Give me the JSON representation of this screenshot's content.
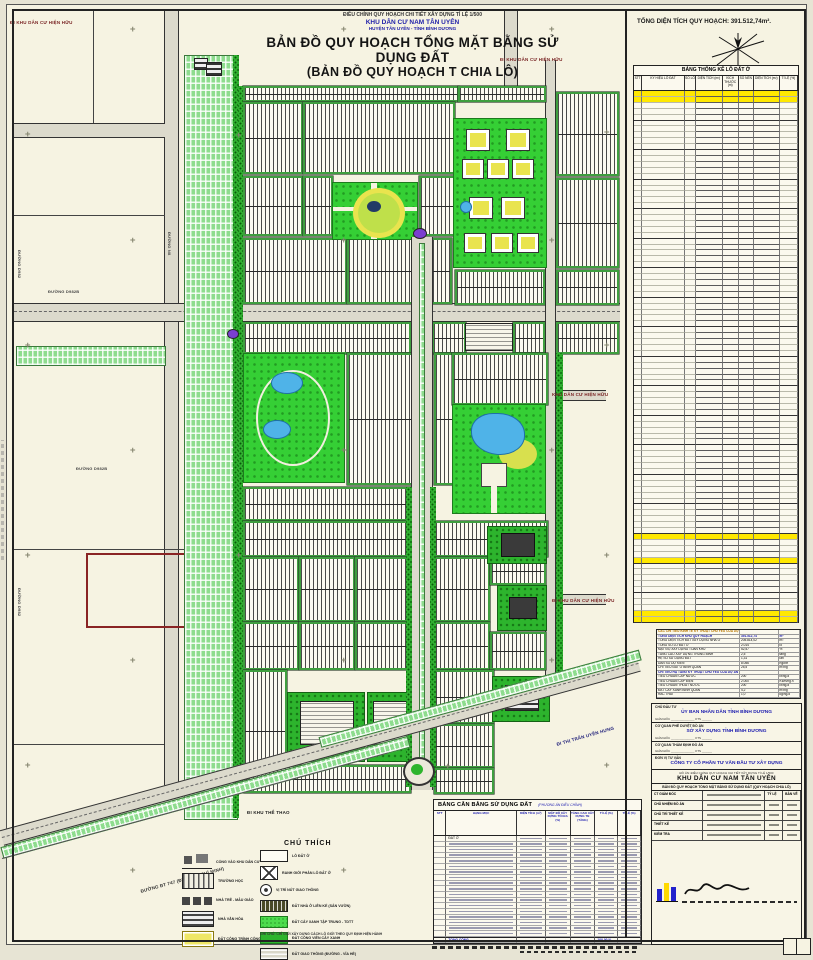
{
  "header": {
    "line1": "ĐIỀU CHỈNH QUY HOẠCH CHI TIẾT XÂY DỰNG TỈ LỆ 1/500",
    "line2": "KHU DÂN CƯ NAM TÂN UYÊN",
    "line3": "HUYỆN TÂN UYÊN - TỈNH BÌNH DƯƠNG",
    "title1": "BẢN ĐỒ QUY HOẠCH TỔNG MẶT BẰNG SỬ DỤNG ĐẤT",
    "title2": "(BẢN ĐỒ QUY HOẠCH T CHIA LÔ)",
    "total_area": "TỔNG DIỆN TÍCH QUY HOẠCH: 391.512,74m²."
  },
  "map": {
    "labels": [
      {
        "text": "ĐI KHU DÂN CƯ HIỆN HỮU",
        "x": 10,
        "y": 20,
        "rot": 0,
        "color": "#7a2525",
        "size": 4.5
      },
      {
        "text": "ĐI KHU DÂN CƯ HIỆN HỮU",
        "x": 500,
        "y": 57,
        "rot": 0,
        "color": "#7a2525",
        "size": 4.5
      },
      {
        "text": "KHU DÂN CƯ HIỆN HỮU",
        "x": 552,
        "y": 392,
        "rot": 0,
        "color": "#7a2525",
        "size": 4.5
      },
      {
        "text": "ĐI KHU DÂN CƯ HIỆN HỮU",
        "x": 552,
        "y": 598,
        "rot": 0,
        "color": "#7a2525",
        "size": 4.5
      },
      {
        "text": "ĐI THỊ TRẤN UYÊN HƯNG",
        "x": 556,
        "y": 742,
        "rot": -16,
        "color": "#20207a",
        "size": 4.5
      },
      {
        "text": "ĐƯỜNG ĐT 747 (ĐI TP. HỒ CHÍ MINH)",
        "x": 140,
        "y": 889,
        "rot": -15.5,
        "color": "#333333",
        "size": 4.5
      },
      {
        "text": "ĐƯỜNG D982B",
        "x": 48,
        "y": 289,
        "rot": 0,
        "color": "#444444",
        "size": 4
      },
      {
        "text": "ĐƯỜNG D982B",
        "x": 76,
        "y": 466,
        "rot": 0,
        "color": "#444444",
        "size": 4
      },
      {
        "text": "ĐƯỜNG D982",
        "x": 22,
        "y": 250,
        "rot": 90,
        "color": "#444444",
        "size": 4
      },
      {
        "text": "ĐƯỜNG D982",
        "x": 22,
        "y": 588,
        "rot": 90,
        "color": "#444444",
        "size": 4
      },
      {
        "text": "ĐƯỜNG N8",
        "x": 172,
        "y": 232,
        "rot": 90,
        "color": "#444444",
        "size": 4
      },
      {
        "text": "ĐI KHU THỂ THAO",
        "x": 247,
        "y": 810,
        "rot": 0,
        "color": "#222222",
        "size": 4.5
      }
    ],
    "crosses": [
      [
        130,
        25
      ],
      [
        341,
        25
      ],
      [
        549,
        25
      ],
      [
        25,
        130
      ],
      [
        236,
        131
      ],
      [
        604,
        128
      ],
      [
        130,
        236
      ],
      [
        341,
        236
      ],
      [
        549,
        236
      ],
      [
        25,
        341
      ],
      [
        604,
        341
      ],
      [
        130,
        446
      ],
      [
        341,
        446
      ],
      [
        549,
        446
      ],
      [
        25,
        551
      ],
      [
        236,
        551
      ],
      [
        604,
        551
      ],
      [
        130,
        656
      ],
      [
        341,
        656
      ],
      [
        549,
        656
      ],
      [
        25,
        761
      ],
      [
        445,
        762
      ],
      [
        604,
        761
      ],
      [
        130,
        866
      ],
      [
        341,
        866
      ],
      [
        467,
        866
      ]
    ]
  },
  "stat_table": {
    "title": "BẢNG THỐNG KÊ LÔ ĐẤT Ở",
    "columns": [
      "STT",
      "KÝ HIỆU LÔ ĐẤT",
      "SỐ LÔ",
      "DIỆN TÍCH (m²)",
      "KÍCH THƯỚC (m)",
      "SỐ NỀN",
      "DIỆN TÍCH (m²)",
      "TỈ LỆ (%)"
    ],
    "row_count": 90,
    "yellow_rows": [
      0,
      1,
      75,
      79,
      88,
      89
    ]
  },
  "summary_table": {
    "rows": [
      {
        "l": "CÁC CHỈ TIÊU KINH TẾ KỸ THUẬT CHỦ YẾU CỦA DỰ ÁN",
        "v": "",
        "u": "",
        "s": "head"
      },
      {
        "l": "TỔNG DIỆN TÍCH KHU QUY HOẠCH",
        "v": "391.512,74",
        "u": "m²",
        "s": "blue"
      },
      {
        "l": "TỔNG DIỆN TÍCH ĐẤT XÂY DỰNG NHÀ Ở",
        "v": "205.814,02",
        "u": "m²",
        "s": "plain"
      },
      {
        "l": "TỔNG SỐ LÔ ĐẤT Ở",
        "v": "2.014",
        "u": "lô",
        "s": "plain"
      },
      {
        "l": "MẬT ĐỘ XÂY DỰNG TOÀN KHU",
        "v": "52,57",
        "u": "%",
        "s": "plain"
      },
      {
        "l": "TẦNG CAO XÂY DỰNG TRUNG BÌNH",
        "v": "2,5",
        "u": "tầng",
        "s": "plain"
      },
      {
        "l": "HỆ SỐ SỬ DỤNG ĐẤT",
        "v": "1,31",
        "u": "lần",
        "s": "plain"
      },
      {
        "l": "DÂN SỐ DỰ KIẾN",
        "v": "8.056",
        "u": "người",
        "s": "plain"
      },
      {
        "l": "CHỈ TIÊU ĐẤT Ở BÌNH QUÂN",
        "v": "25,5",
        "u": "m²/ng",
        "s": "plain"
      },
      {
        "l": "CHỈ TIÊU HẠ TẦNG KỸ THUẬT CHỦ YẾU CỦA DỰ ÁN",
        "v": "",
        "u": "",
        "s": "blue"
      },
      {
        "l": "TIÊU CHUẨN CẤP NƯỚC",
        "v": "200",
        "u": "lít/ng.đ",
        "s": "plain"
      },
      {
        "l": "TIÊU CHUẨN CẤP ĐIỆN",
        "v": "2.000",
        "u": "KWh/ng.n",
        "s": "plain"
      },
      {
        "l": "TIÊU CHUẨN THOÁT NƯỚC",
        "v": "200",
        "u": "lít/ng.đ",
        "s": "plain"
      },
      {
        "l": "ĐẤT CÂY XANH BÌNH QUÂN",
        "v": "4,2",
        "u": "m²/ng",
        "s": "plain"
      },
      {
        "l": "RÁC THẢI",
        "v": "1,0",
        "u": "kg/ng.đ",
        "s": "plain"
      }
    ]
  },
  "balance_table": {
    "title": "BẢNG CÂN BẰNG SỬ DỤNG ĐẤT",
    "note": "(PHƯƠNG ÁN ĐIỀU CHỈNH)",
    "columns": [
      "STT",
      "HẠNG MỤC",
      "DIỆN TÍCH (m²)",
      "MẬT ĐỘ XÂY DỰNG TỐI ĐA (%)",
      "TẦNG CAO XÂY DỰNG TB (TẦNG)",
      "TỈ LỆ (%)",
      "TỈ LỆ (%)"
    ],
    "row_count": 19,
    "first_label": "ĐẤT Ở",
    "total_label": "TỔNG CỘNG",
    "total_value": "100,00 %"
  },
  "legend": {
    "title": "CHÚ THÍCH",
    "left_items": [
      {
        "icon": "gate-icon",
        "label": "CỔNG VÀO KHU DÂN CƯ"
      },
      {
        "icon": "school-icon",
        "label": "TRƯỜNG HỌC"
      },
      {
        "icon": "kindergarten-icon",
        "label": "NHÀ TRẺ - MẪU GIÁO"
      },
      {
        "icon": "market-icon",
        "label": "NHÀ VĂN HÓA"
      },
      {
        "icon": "public-icon",
        "label": "ĐẤT CÔNG TRÌNH CÔNG CỘNG"
      }
    ],
    "right_items": [
      {
        "icon": "lot-swatch",
        "label": "LÔ ĐẤT Ở"
      },
      {
        "icon": "boundary-swatch",
        "label": "RANH GIỚI PHÂN LÔ ĐẤT Ở"
      },
      {
        "icon": "node-swatch",
        "label": "VỊ TRÍ NÚT GIAO THÔNG"
      },
      {
        "icon": "rowhouse-swatch",
        "label": "ĐẤT NHÀ Ở LIÊN KẾ (SÂN VƯỜN)"
      },
      {
        "icon": "greenery-swatch",
        "label": "ĐẤT CÂY XANH TẬP TRUNG - TDTT"
      },
      {
        "icon": "park-swatch",
        "label": "ĐẤT CÔNG VIÊN CÂY XANH"
      },
      {
        "icon": "road-swatch",
        "label": "ĐẤT GIAO THÔNG (ĐƯỜNG - VỈA HÈ)"
      }
    ],
    "note": "GHI CHÚ: CHỈ GIỚI XÂY DỰNG CÁCH LỘ GIỚI THEO QUY ĐỊNH HIỆN HÀNH"
  },
  "title_block": {
    "sections": [
      {
        "role": "CHỦ ĐẦU TƯ",
        "name": "ỦY BAN NHÂN DÂN TỈNH BÌNH DƯƠNG",
        "sig": "GIÁM ĐỐC ______________  KTS ______"
      },
      {
        "role": "CƠ QUAN PHÊ DUYỆT ĐỒ ÁN",
        "name": "SỞ XÂY DỰNG TỈNH BÌNH DƯƠNG",
        "sig": "GIÁM ĐỐC ______________  KTS ______"
      },
      {
        "role": "CƠ QUAN THẨM ĐỊNH ĐỒ ÁN",
        "name": " ",
        "sig": "GIÁM ĐỐC ______________  KTS ______"
      },
      {
        "role": "ĐƠN VỊ TƯ VẤN",
        "name": "CÔNG TY CỔ PHẦN TƯ VẤN ĐẦU TƯ XÂY DỰNG",
        "sig": ""
      }
    ],
    "project_caption": "ĐỒ ÁN: ĐIỀU CHỈNH QUY HOẠCH CHI TIẾT XÂY DỰNG TỈ LỆ 1/500",
    "project_name": "KHU DÂN CƯ NAM TÂN UYÊN",
    "drawing_name": "BẢN ĐỒ QUY HOẠCH TỔNG MẶT BẰNG SỬ DỤNG ĐẤT (QUY HOẠCH CHIA LÔ)",
    "sign_rows": [
      "CT GIÁM ĐỐC",
      "CHỦ NHIỆM ĐỒ ÁN",
      "CHỦ TRÌ THIẾT KẾ",
      "THIẾT KẾ",
      "KIỂM TRA"
    ],
    "scale_label": "TỶ LỆ",
    "sheet_label": "BẢN VẼ",
    "stamp_label": "VỊ TRÍ BẢN VẼ"
  }
}
